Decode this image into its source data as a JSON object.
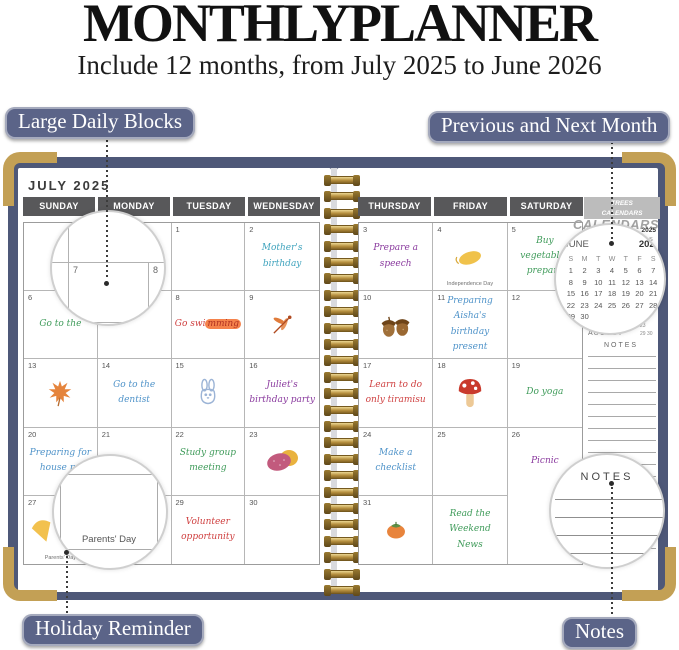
{
  "page": {
    "title": "MONTHLYPLANNER",
    "subtitle": "Include 12 months, from July 2025 to June 2026"
  },
  "callouts": {
    "large_daily_blocks": "Large Daily Blocks",
    "previous_next_month": "Previous and Next Month",
    "holiday_reminder": "Holiday Reminder",
    "notes": "Notes"
  },
  "colors": {
    "green": "#3f9b5a",
    "blue": "#4f93c9",
    "teal": "#3fa3bd",
    "purple": "#8a3a9e",
    "red": "#cf4040",
    "highlight": "#f5824b",
    "cover": "#4e5878",
    "gold": "#c3a055",
    "badge": "#5b6488"
  },
  "planner": {
    "month_title": "JULY 2025",
    "weekday_headers_left": [
      "SUNDAY",
      "MONDAY",
      "TUESDAY",
      "WEDNESDAY"
    ],
    "weekday_headers_right": [
      "THURSDAY",
      "FRIDAY",
      "SATURDAY"
    ],
    "left_grid": [
      [
        {},
        {},
        {
          "d": "1"
        },
        {
          "d": "2",
          "note": "Mother's birthday",
          "c": "teal"
        }
      ],
      [
        {
          "d": "6",
          "note": "Go to the",
          "c": "green"
        },
        {
          "d": "7"
        },
        {
          "d": "8",
          "note": "Go swimming",
          "c": "red",
          "hl": "mming"
        },
        {
          "d": "9",
          "icon": "dragonfly"
        }
      ],
      [
        {
          "d": "13",
          "icon": "maple-leaf"
        },
        {
          "d": "14",
          "note": "Go to the dentist",
          "c": "blue"
        },
        {
          "d": "15",
          "icon": "bunny"
        },
        {
          "d": "16",
          "note": "Juliet's birthday party",
          "c": "purple"
        }
      ],
      [
        {
          "d": "20",
          "note": "Preparing for house pa",
          "c": "blue"
        },
        {
          "d": "21"
        },
        {
          "d": "22",
          "note": "Study group meeting",
          "c": "green"
        },
        {
          "d": "23",
          "icon": "sweet-potato"
        }
      ],
      [
        {
          "d": "27",
          "icon": "ginkgo",
          "align": "left",
          "holiday": "Parents' Day"
        },
        {
          "d": "28"
        },
        {
          "d": "29",
          "note": "Volunteer opportunity",
          "c": "red"
        },
        {
          "d": "30"
        }
      ]
    ],
    "right_grid": [
      [
        {
          "d": "3",
          "note": "Prepare a speech",
          "c": "purple"
        },
        {
          "d": "4",
          "icon": "yellow-leaf",
          "holiday": "Independence Day"
        },
        {
          "d": "5",
          "note": "Buy vegetables prepare",
          "c": "green"
        }
      ],
      [
        {
          "d": "10",
          "icon": "acorns"
        },
        {
          "d": "11",
          "note": "Preparing Aisha's birthday present",
          "c": "blue"
        },
        {
          "d": "12"
        }
      ],
      [
        {
          "d": "17",
          "note": "Learn to do only tiramisu",
          "c": "red"
        },
        {
          "d": "18",
          "icon": "mushroom"
        },
        {
          "d": "19",
          "note": "Do yoga",
          "c": "green"
        }
      ],
      [
        {
          "d": "24",
          "note": "Make a checklist",
          "c": "blue"
        },
        {
          "d": "25"
        },
        {
          "d": "26",
          "note": "Picnic",
          "c": "purple"
        }
      ],
      [
        {
          "d": "31",
          "icon": "persimmon"
        },
        {
          "note": "Read the Weekend News",
          "c": "green"
        },
        {}
      ]
    ],
    "sidebar": {
      "tab_line1": "TREES",
      "tab_line2": "CALENDARS",
      "tab_big": "CALENDARS",
      "mini_june": {
        "month": "JUNE",
        "year": "2025",
        "dow": [
          "S",
          "M",
          "T",
          "W",
          "T",
          "F",
          "S"
        ],
        "weeks": [
          [
            "1",
            "2",
            "3",
            "4",
            "5",
            "6",
            "7"
          ],
          [
            "8",
            "9",
            "10",
            "11",
            "12",
            "13",
            "14"
          ],
          [
            "15",
            "16",
            "17",
            "18",
            "19",
            "20",
            "21"
          ],
          [
            "22",
            "23",
            "24",
            "25",
            "26",
            "27",
            "28"
          ],
          [
            "29",
            "30",
            "",
            "",
            "",
            "",
            ""
          ]
        ]
      },
      "august_label": "AUGUST",
      "august_fragments": [
        "23",
        "29 30"
      ],
      "notes_label": "NOTES"
    },
    "magnifiers": {
      "daily_blocks": {
        "day_a": "7",
        "day_b": "8"
      },
      "holiday": {
        "text": "Parents' Day"
      },
      "notes": {
        "label": "NOTES"
      }
    }
  }
}
